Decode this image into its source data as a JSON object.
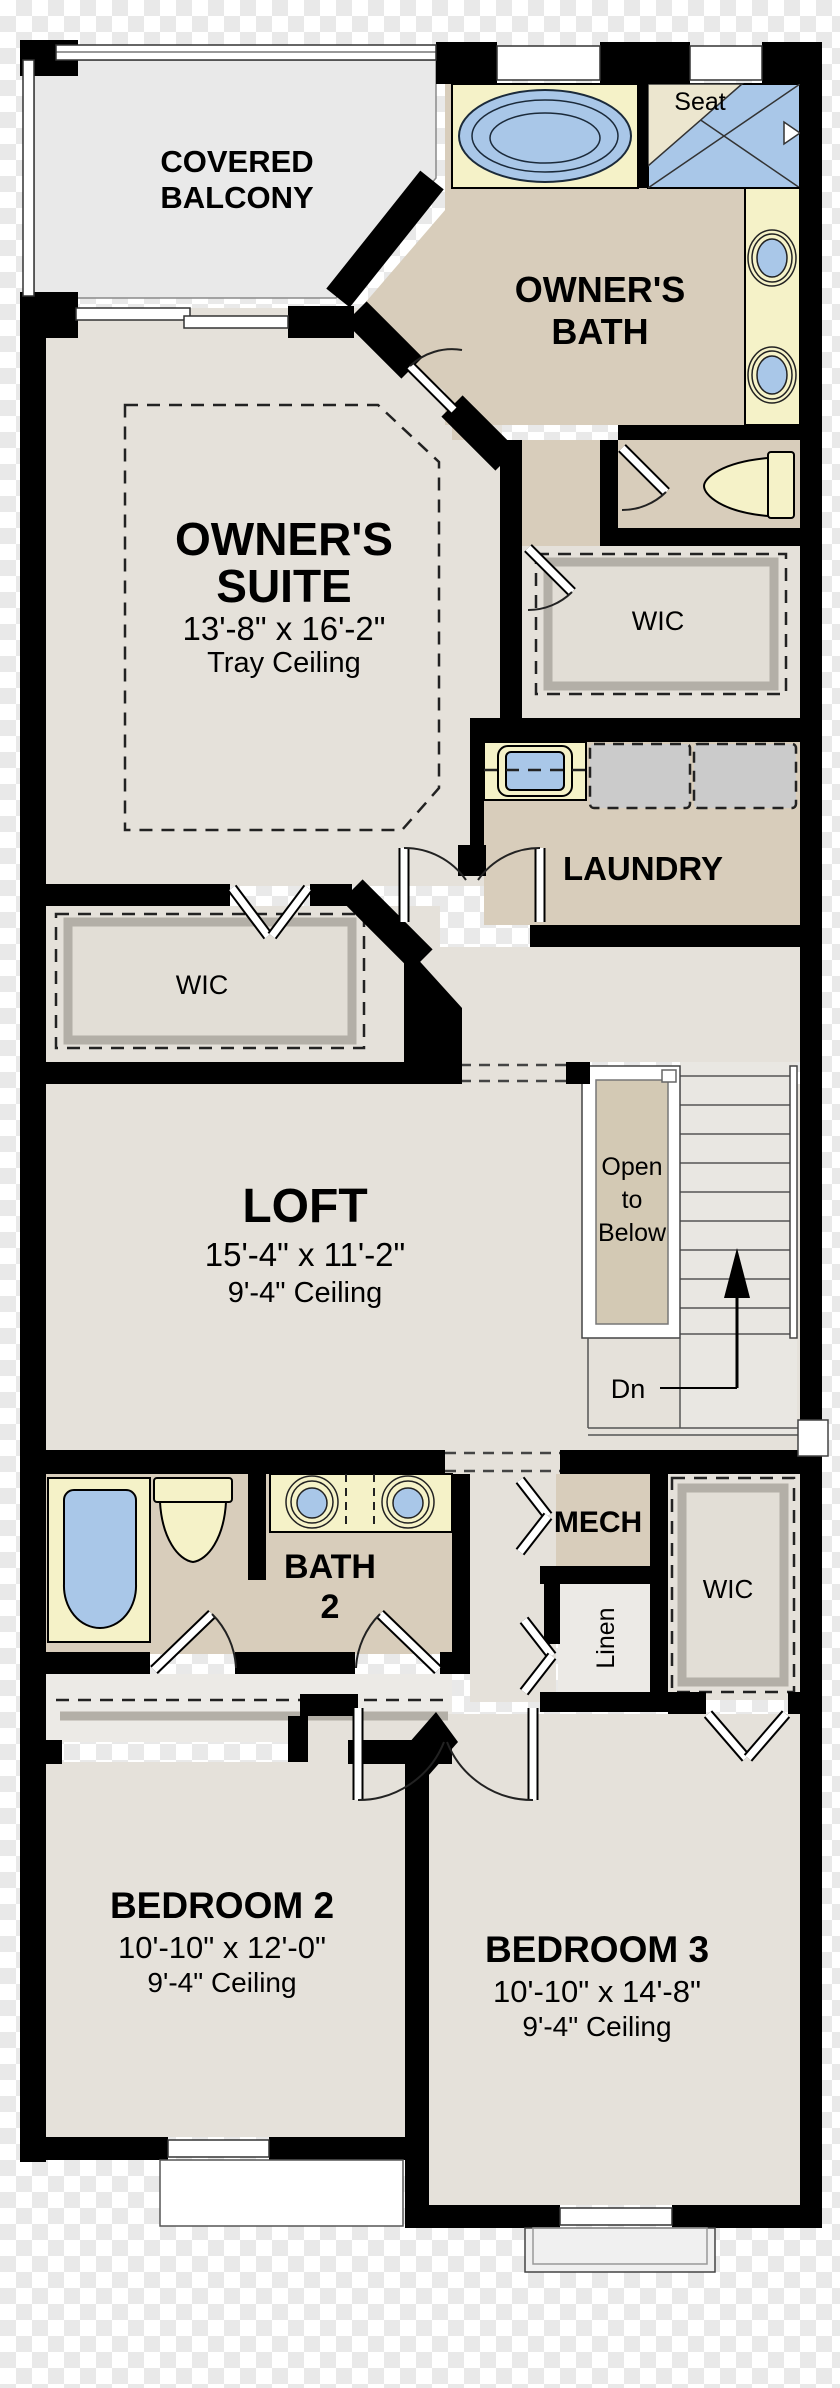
{
  "plan_title": "Second Floor Plan",
  "colors": {
    "wall": "#000000",
    "floor_main": "#e5e1da",
    "floor_tan": "#d8cdbb",
    "counter_yellow": "#f5f2c8",
    "fixture_blue": "#a9c7e8",
    "balcony_gray": "#e9e9e9",
    "appliance_gray": "#cbcbcb",
    "shelf_gray": "#b3afa7",
    "open_below_tan": "#d3c9b4"
  },
  "rooms": {
    "covered_balcony": {
      "line1": "COVERED",
      "line2": "BALCONY"
    },
    "owners_bath": {
      "line1": "OWNER'S",
      "line2": "BATH"
    },
    "shower": {
      "seat": "Seat"
    },
    "owners_suite": {
      "line1": "OWNER'S",
      "line2": "SUITE",
      "dims": "13'-8\" x 16'-2\"",
      "ceiling": "Tray Ceiling"
    },
    "wic_hall": {
      "label": "WIC"
    },
    "laundry": {
      "label": "LAUNDRY"
    },
    "wic_owners": {
      "label": "WIC"
    },
    "loft": {
      "label": "LOFT",
      "dims": "15'-4\" x 11'-2\"",
      "ceiling": "9'-4\" Ceiling"
    },
    "stair": {
      "open1": "Open",
      "open2": "to",
      "open3": "Below",
      "dn": "Dn"
    },
    "bath2": {
      "line1": "BATH",
      "line2": "2"
    },
    "mech": {
      "label": "MECH"
    },
    "linen": {
      "label": "Linen"
    },
    "wic_bed3": {
      "label": "WIC"
    },
    "bedroom2": {
      "label": "BEDROOM 2",
      "dims": "10'-10\" x 12'-0\"",
      "ceiling": "9'-4\" Ceiling"
    },
    "bedroom3": {
      "label": "BEDROOM 3",
      "dims": "10'-10\" x 14'-8\"",
      "ceiling": "9'-4\" Ceiling"
    }
  }
}
